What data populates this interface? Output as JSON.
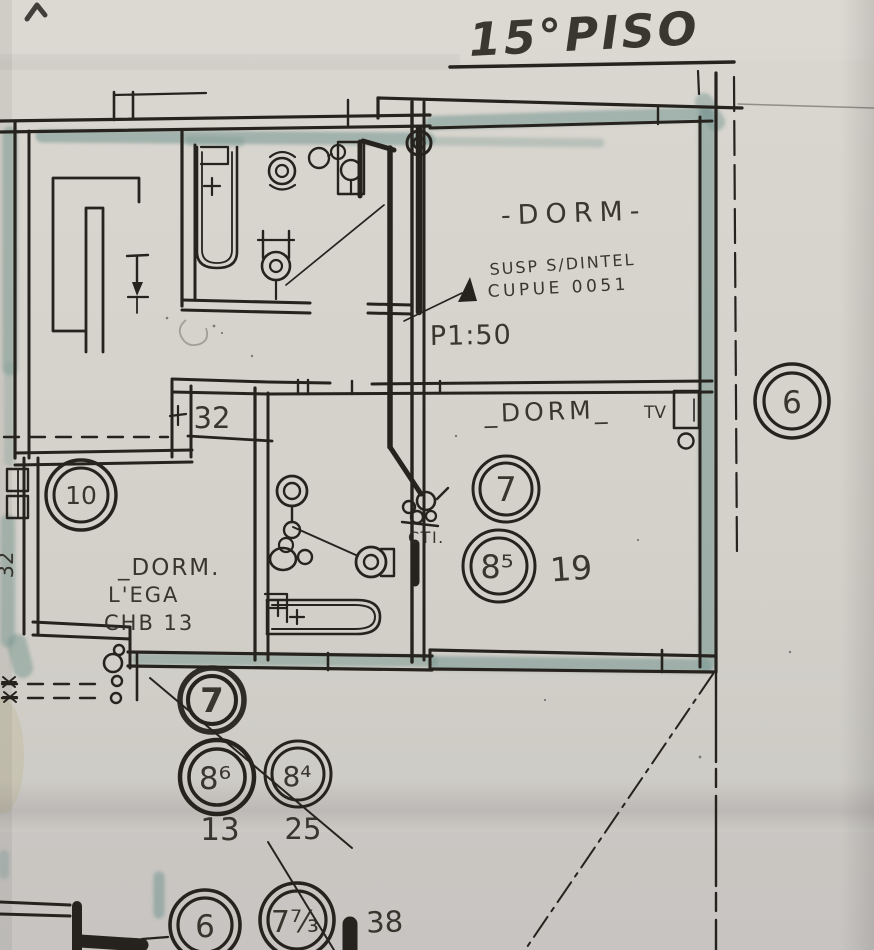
{
  "title": {
    "text": "15°PISO"
  },
  "annotations": {
    "dorm_top_label": "-DORM-",
    "susp_note_line1": "SUSP S/DINTEL",
    "susp_note_line2": "CUPUE 0051",
    "scale_note": "P1:50",
    "dorm_right_label": "_DORM_",
    "tv_label": "TV",
    "cti_label": "CTI.",
    "dorm_left_label": "_DORM.",
    "dorm_left_line2": "L'EGA",
    "dorm_left_line3": "CHB 13"
  },
  "dimensions": {
    "width_32_top": "32",
    "width_32_left": "32"
  },
  "markers": {
    "room7": "7",
    "room8s": "8⁵",
    "value19": "19",
    "room6_right": "6",
    "room10": "10",
    "lower7": "7",
    "lower86": "8⁶",
    "value13": "13",
    "lower84": "8⁴",
    "value25": "25",
    "bottom6": "6",
    "bottom73": "7⁷⁄₃",
    "value38": "38"
  },
  "colors": {
    "paper": "#d6d3cc",
    "ink": "#26231f",
    "wall_wash_teal": "#7d9a94"
  }
}
